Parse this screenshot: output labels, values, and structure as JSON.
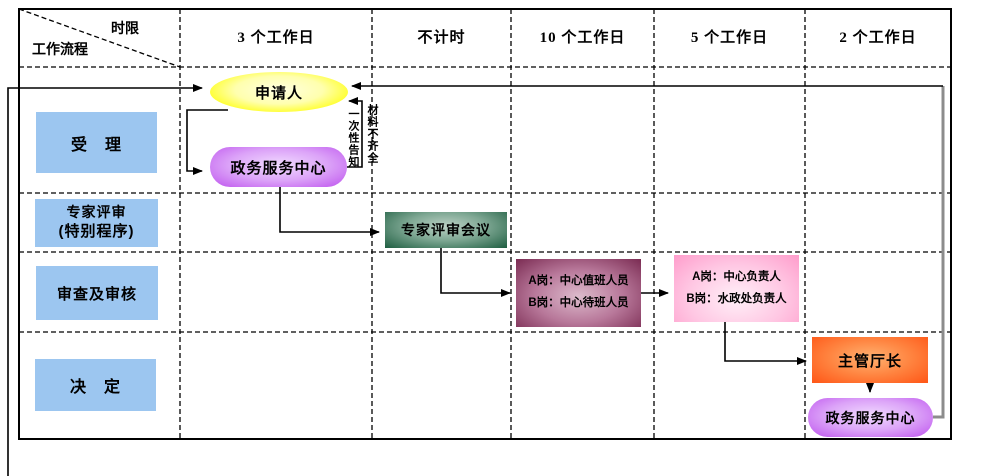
{
  "header": {
    "corner_top": "时限",
    "corner_bottom": "工作流程",
    "columns": [
      "3 个工作日",
      "不计时",
      "10 个工作日",
      "5 个工作日",
      "2 个工作日"
    ]
  },
  "lanes": [
    {
      "label": "受　理"
    },
    {
      "label": "专家评审",
      "label2": "(特别程序)"
    },
    {
      "label": "审查及审核"
    },
    {
      "label": "决　定"
    }
  ],
  "nodes": {
    "applicant": {
      "label": "申请人"
    },
    "service_center_top": {
      "label": "政务服务中心"
    },
    "expert_meeting": {
      "label": "专家评审会议"
    },
    "duty_post": {
      "line1": "A岗：中心值班人员",
      "line2": "B岗：中心待班人员"
    },
    "lead_post": {
      "line1": "A岗：中心负责人",
      "line2": "B岗：水政处负责人"
    },
    "director": {
      "label": "主管厅长"
    },
    "service_center_bottom": {
      "label": "政务服务中心"
    }
  },
  "annotations": {
    "materials_incomplete": "材料不齐全",
    "one_time_notice": "一次性告知"
  },
  "colors": {
    "lane_label_bg": "#9CC6F0",
    "applicant_fill_edge": "#FFFF00",
    "applicant_fill_center": "#FFFFE2",
    "service_center_fill_edge": "#C463F0",
    "service_center_fill_center": "#F1DBFF",
    "expert_fill_edge": "#1E5E41",
    "expert_fill_center": "#BCD1C5",
    "duty_fill_edge": "#7A2B52",
    "duty_fill_center": "#DDBBCC",
    "lead_fill_edge": "#FF9CCB",
    "lead_fill_center": "#FFF0F8",
    "director_fill_edge": "#FF5A1A",
    "director_fill_center": "#FFB271",
    "feedback_line": "#8C8C8C",
    "line": "#000000",
    "text": "#000000"
  }
}
